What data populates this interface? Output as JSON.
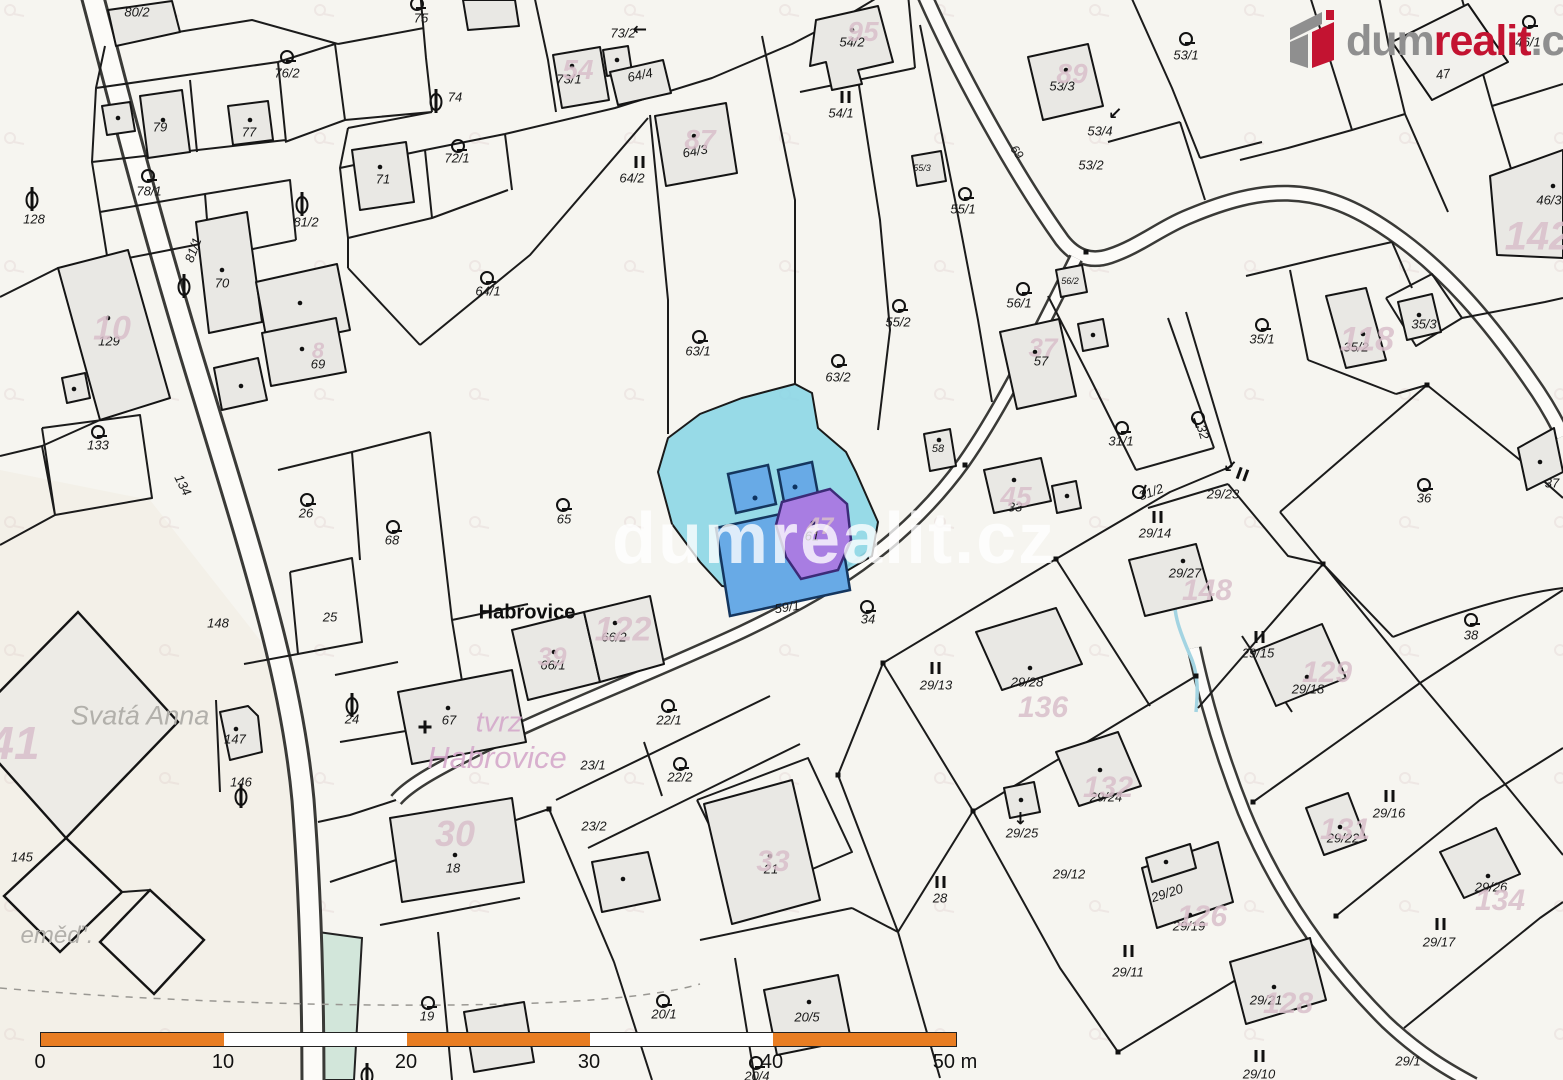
{
  "logo": {
    "dum": "dum",
    "realit": "realit",
    "cz": ".cz"
  },
  "watermark": {
    "text": "dumrealit.cz"
  },
  "scalebar": {
    "ticks": [
      "0",
      "10",
      "20",
      "30",
      "40",
      "50 m"
    ]
  },
  "map": {
    "colors": {
      "highlight_parcel": "#8ed7e6",
      "highlight_building": "#68aae6",
      "selected_building": "#a87de2",
      "building_fill": "#e9e8e4",
      "pink_label": "#d9bfcb",
      "scalebar_orange": "#e87d22",
      "brand_red": "#c31331",
      "brand_gray": "#8f8f8f"
    },
    "place_labels": [
      {
        "t": "Habrovice",
        "x": 527,
        "y": 613,
        "cls": "place-black",
        "s": 20
      },
      {
        "t": "Svatá Anna",
        "x": 140,
        "y": 716,
        "cls": "place-gray",
        "s": 27
      },
      {
        "t": "tvrz",
        "x": 499,
        "y": 723,
        "cls": "place-pink",
        "s": 29
      },
      {
        "t": "Habrovice",
        "x": 497,
        "y": 758,
        "cls": "place-pink",
        "s": 31
      },
      {
        "t": "eměď'.",
        "x": 57,
        "y": 936,
        "cls": "place-gray",
        "s": 24
      }
    ],
    "parcel_labels": [
      {
        "t": "80/2",
        "x": 137,
        "y": 12
      },
      {
        "t": "76/2",
        "x": 287,
        "y": 73
      },
      {
        "t": "79",
        "x": 160,
        "y": 127
      },
      {
        "t": "77",
        "x": 249,
        "y": 132
      },
      {
        "t": "78/1",
        "x": 149,
        "y": 191
      },
      {
        "t": "128",
        "x": 34,
        "y": 219
      },
      {
        "t": "81/2",
        "x": 306,
        "y": 222
      },
      {
        "t": "81/1",
        "x": 193,
        "y": 250,
        "rot": -70
      },
      {
        "t": "70",
        "x": 222,
        "y": 283
      },
      {
        "t": "71",
        "x": 383,
        "y": 179
      },
      {
        "t": "72/1",
        "x": 457,
        "y": 158
      },
      {
        "t": "74",
        "x": 455,
        "y": 97
      },
      {
        "t": "75",
        "x": 421,
        "y": 18
      },
      {
        "t": "73/2",
        "x": 623,
        "y": 33
      },
      {
        "t": "73/1",
        "x": 569,
        "y": 79
      },
      {
        "t": "64/4",
        "x": 640,
        "y": 75,
        "rot": -12
      },
      {
        "t": "64/3",
        "x": 695,
        "y": 151,
        "rot": -10
      },
      {
        "t": "64/2",
        "x": 632,
        "y": 178
      },
      {
        "t": "64/1",
        "x": 488,
        "y": 291
      },
      {
        "t": "63/1",
        "x": 698,
        "y": 351
      },
      {
        "t": "63/2",
        "x": 838,
        "y": 377
      },
      {
        "t": "55/2",
        "x": 898,
        "y": 322
      },
      {
        "t": "55/1",
        "x": 963,
        "y": 209
      },
      {
        "t": "55/3",
        "x": 922,
        "y": 168,
        "s": 9
      },
      {
        "t": "54/2",
        "x": 852,
        "y": 42
      },
      {
        "t": "54/1",
        "x": 841,
        "y": 113
      },
      {
        "t": "53/3",
        "x": 1062,
        "y": 86
      },
      {
        "t": "53/4",
        "x": 1100,
        "y": 131
      },
      {
        "t": "53/2",
        "x": 1091,
        "y": 165
      },
      {
        "t": "53/1",
        "x": 1186,
        "y": 55
      },
      {
        "t": "69",
        "x": 1017,
        "y": 152,
        "rot": 55,
        "s": 12
      },
      {
        "t": "46/1",
        "x": 1528,
        "y": 42
      },
      {
        "t": "47",
        "x": 1443,
        "y": 74,
        "rot": -8
      },
      {
        "t": "46/3",
        "x": 1549,
        "y": 200
      },
      {
        "t": "35/3",
        "x": 1424,
        "y": 324
      },
      {
        "t": "35/2",
        "x": 1356,
        "y": 347
      },
      {
        "t": "35/1",
        "x": 1262,
        "y": 339
      },
      {
        "t": "37",
        "x": 1552,
        "y": 483
      },
      {
        "t": "57",
        "x": 1041,
        "y": 361
      },
      {
        "t": "56/1",
        "x": 1019,
        "y": 303
      },
      {
        "t": "56/2",
        "x": 1070,
        "y": 281,
        "s": 9
      },
      {
        "t": "58",
        "x": 938,
        "y": 449,
        "s": 11
      },
      {
        "t": "33",
        "x": 1015,
        "y": 507
      },
      {
        "t": "31/1",
        "x": 1121,
        "y": 441
      },
      {
        "t": "32",
        "x": 1203,
        "y": 432,
        "rot": 72
      },
      {
        "t": "31/2",
        "x": 1151,
        "y": 492,
        "rot": -20
      },
      {
        "t": "29/23",
        "x": 1223,
        "y": 494
      },
      {
        "t": "29/14",
        "x": 1155,
        "y": 533
      },
      {
        "t": "36",
        "x": 1424,
        "y": 498
      },
      {
        "t": "38",
        "x": 1471,
        "y": 635
      },
      {
        "t": "34",
        "x": 868,
        "y": 619
      },
      {
        "t": "29/13",
        "x": 936,
        "y": 685
      },
      {
        "t": "29/28",
        "x": 1027,
        "y": 682
      },
      {
        "t": "29/27",
        "x": 1185,
        "y": 573
      },
      {
        "t": "29/24",
        "x": 1106,
        "y": 797
      },
      {
        "t": "29/25",
        "x": 1022,
        "y": 833
      },
      {
        "t": "29/12",
        "x": 1069,
        "y": 874
      },
      {
        "t": "29/20",
        "x": 1167,
        "y": 893,
        "rot": -18
      },
      {
        "t": "29/19",
        "x": 1189,
        "y": 926
      },
      {
        "t": "29/11",
        "x": 1128,
        "y": 972
      },
      {
        "t": "29/21",
        "x": 1266,
        "y": 1000
      },
      {
        "t": "29/10",
        "x": 1259,
        "y": 1074
      },
      {
        "t": "29/1",
        "x": 1408,
        "y": 1061
      },
      {
        "t": "29/22",
        "x": 1343,
        "y": 838
      },
      {
        "t": "29/26",
        "x": 1491,
        "y": 887
      },
      {
        "t": "29/17",
        "x": 1439,
        "y": 942
      },
      {
        "t": "29/16",
        "x": 1389,
        "y": 813
      },
      {
        "t": "29/15",
        "x": 1258,
        "y": 653
      },
      {
        "t": "29/18",
        "x": 1308,
        "y": 689
      },
      {
        "t": "129",
        "x": 109,
        "y": 341
      },
      {
        "t": "133",
        "x": 98,
        "y": 445
      },
      {
        "t": "134",
        "x": 183,
        "y": 485,
        "rot": 63
      },
      {
        "t": "26",
        "x": 306,
        "y": 513
      },
      {
        "t": "68",
        "x": 392,
        "y": 540
      },
      {
        "t": "65",
        "x": 564,
        "y": 519
      },
      {
        "t": "25",
        "x": 330,
        "y": 617
      },
      {
        "t": "148",
        "x": 218,
        "y": 623
      },
      {
        "t": "24",
        "x": 352,
        "y": 719
      },
      {
        "t": "67",
        "x": 449,
        "y": 720
      },
      {
        "t": "147",
        "x": 235,
        "y": 739
      },
      {
        "t": "146",
        "x": 241,
        "y": 782
      },
      {
        "t": "145",
        "x": 22,
        "y": 857
      },
      {
        "t": "66/1",
        "x": 553,
        "y": 665
      },
      {
        "t": "66/2",
        "x": 614,
        "y": 637
      },
      {
        "t": "22/1",
        "x": 669,
        "y": 720
      },
      {
        "t": "23/1",
        "x": 593,
        "y": 765
      },
      {
        "t": "22/2",
        "x": 680,
        "y": 777
      },
      {
        "t": "23/2",
        "x": 594,
        "y": 826
      },
      {
        "t": "18",
        "x": 453,
        "y": 868
      },
      {
        "t": "19",
        "x": 427,
        "y": 1016
      },
      {
        "t": "21",
        "x": 771,
        "y": 869
      },
      {
        "t": "20/1",
        "x": 664,
        "y": 1014
      },
      {
        "t": "20/5",
        "x": 807,
        "y": 1017
      },
      {
        "t": "20/4",
        "x": 757,
        "y": 1076
      },
      {
        "t": "59/1",
        "x": 787,
        "y": 607,
        "rot": -9
      },
      {
        "t": "61",
        "x": 812,
        "y": 536
      },
      {
        "t": "28",
        "x": 940,
        "y": 898
      },
      {
        "t": "69",
        "x": 318,
        "y": 364
      }
    ],
    "building_number_labels": [
      {
        "t": "95",
        "x": 863,
        "y": 32,
        "s": 28
      },
      {
        "t": "54",
        "x": 578,
        "y": 70,
        "s": 28
      },
      {
        "t": "87",
        "x": 700,
        "y": 140,
        "s": 28
      },
      {
        "t": "89",
        "x": 1072,
        "y": 74,
        "s": 28
      },
      {
        "t": "142",
        "x": 1538,
        "y": 237,
        "s": 40
      },
      {
        "t": "118",
        "x": 1367,
        "y": 340,
        "s": 34
      },
      {
        "t": "37",
        "x": 1043,
        "y": 348,
        "s": 26
      },
      {
        "t": "45",
        "x": 1016,
        "y": 497,
        "s": 28
      },
      {
        "t": "148",
        "x": 1207,
        "y": 591,
        "s": 30
      },
      {
        "t": "136",
        "x": 1043,
        "y": 708,
        "s": 30
      },
      {
        "t": "132",
        "x": 1108,
        "y": 788,
        "s": 30
      },
      {
        "t": "129",
        "x": 1327,
        "y": 673,
        "s": 30
      },
      {
        "t": "131",
        "x": 1345,
        "y": 830,
        "s": 30
      },
      {
        "t": "134",
        "x": 1500,
        "y": 901,
        "s": 30
      },
      {
        "t": "128",
        "x": 1288,
        "y": 1004,
        "s": 30
      },
      {
        "t": "126",
        "x": 1202,
        "y": 917,
        "s": 30
      },
      {
        "t": "122",
        "x": 623,
        "y": 630,
        "s": 34
      },
      {
        "t": "39",
        "x": 552,
        "y": 657,
        "s": 26
      },
      {
        "t": "30",
        "x": 455,
        "y": 834,
        "s": 36
      },
      {
        "t": "33",
        "x": 773,
        "y": 862,
        "s": 30
      },
      {
        "t": "10",
        "x": 112,
        "y": 329,
        "s": 34
      },
      {
        "t": "41",
        "x": 14,
        "y": 743,
        "s": 46
      },
      {
        "t": "8",
        "x": 318,
        "y": 351,
        "s": 22
      },
      {
        "t": "47",
        "x": 820,
        "y": 527,
        "s": 24
      }
    ],
    "symbols": [
      {
        "k": "garden",
        "x": 417,
        "y": 4
      },
      {
        "k": "garden",
        "x": 287,
        "y": 57
      },
      {
        "k": "garden",
        "x": 148,
        "y": 176
      },
      {
        "k": "garden",
        "x": 458,
        "y": 146
      },
      {
        "k": "garden",
        "x": 487,
        "y": 278
      },
      {
        "k": "garden",
        "x": 699,
        "y": 337
      },
      {
        "k": "garden",
        "x": 838,
        "y": 361
      },
      {
        "k": "garden",
        "x": 899,
        "y": 306
      },
      {
        "k": "garden",
        "x": 965,
        "y": 194
      },
      {
        "k": "garden",
        "x": 1186,
        "y": 39
      },
      {
        "k": "garden",
        "x": 1529,
        "y": 22
      },
      {
        "k": "garden",
        "x": 1262,
        "y": 325
      },
      {
        "k": "garden",
        "x": 1122,
        "y": 428
      },
      {
        "k": "garden",
        "x": 1023,
        "y": 289
      },
      {
        "k": "garden",
        "x": 1424,
        "y": 485
      },
      {
        "k": "garden",
        "x": 1471,
        "y": 620
      },
      {
        "k": "garden",
        "x": 867,
        "y": 607
      },
      {
        "k": "garden",
        "x": 307,
        "y": 500
      },
      {
        "k": "garden",
        "x": 393,
        "y": 527
      },
      {
        "k": "garden",
        "x": 563,
        "y": 505
      },
      {
        "k": "garden",
        "x": 98,
        "y": 432
      },
      {
        "k": "garden",
        "x": 428,
        "y": 1003
      },
      {
        "k": "garden",
        "x": 663,
        "y": 1001
      },
      {
        "k": "garden",
        "x": 756,
        "y": 1063
      },
      {
        "k": "garden",
        "x": 668,
        "y": 706
      },
      {
        "k": "garden",
        "x": 680,
        "y": 764
      },
      {
        "k": "garden",
        "x": 1139,
        "y": 492,
        "rot": -70
      },
      {
        "k": "garden",
        "x": 1198,
        "y": 418,
        "rot": 72
      },
      {
        "k": "theta",
        "x": 436,
        "y": 102
      },
      {
        "k": "theta",
        "x": 184,
        "y": 287
      },
      {
        "k": "theta",
        "x": 302,
        "y": 205
      },
      {
        "k": "theta",
        "x": 32,
        "y": 200
      },
      {
        "k": "theta",
        "x": 241,
        "y": 797
      },
      {
        "k": "theta",
        "x": 352,
        "y": 706
      },
      {
        "k": "theta",
        "x": 367,
        "y": 1076
      },
      {
        "k": "meadow",
        "x": 845,
        "y": 97
      },
      {
        "k": "meadow",
        "x": 639,
        "y": 162
      },
      {
        "k": "meadow",
        "x": 935,
        "y": 668
      },
      {
        "k": "meadow",
        "x": 1157,
        "y": 517
      },
      {
        "k": "meadow",
        "x": 940,
        "y": 882
      },
      {
        "k": "meadow",
        "x": 1259,
        "y": 637
      },
      {
        "k": "meadow",
        "x": 1389,
        "y": 796
      },
      {
        "k": "meadow",
        "x": 1440,
        "y": 924
      },
      {
        "k": "meadow",
        "x": 1128,
        "y": 951
      },
      {
        "k": "meadow",
        "x": 1259,
        "y": 1056
      },
      {
        "k": "meadow",
        "x": 1242,
        "y": 474,
        "rot": 20
      },
      {
        "k": "arrow",
        "x": 637,
        "y": 29,
        "rot": 180
      },
      {
        "k": "arrow",
        "x": 1113,
        "y": 115,
        "rot": 135
      },
      {
        "k": "arrow",
        "x": 1228,
        "y": 468,
        "rot": 135
      },
      {
        "k": "arrow",
        "x": 1020,
        "y": 821,
        "rot": 90
      },
      {
        "k": "cross",
        "x": 425,
        "y": 727
      }
    ]
  }
}
